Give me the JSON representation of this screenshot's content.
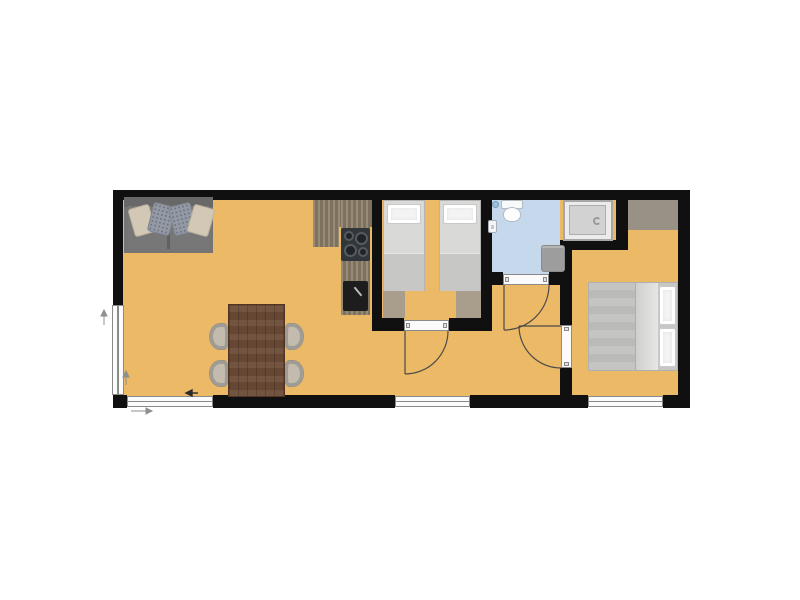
{
  "meta": {
    "kind": "apartment-floor-plan",
    "visible_text": "none",
    "background": "#ffffff"
  },
  "palette": {
    "wall": "#101010",
    "floor": "#ecb966",
    "bathroom-floor": "#c6d9ec",
    "window-fill": "#fbfbfb",
    "frame-line": "#8a8a8a",
    "counter-wood": "#8c7e68",
    "table-wood": "#6b4b36",
    "sofa-gray": "#757575",
    "chair-beige": "#c3bbad",
    "bed-mattress": "#d9d9d7",
    "bed-duvet": "#c7c7c5",
    "pillow-white": "#f4f4f4",
    "rug-tan": "#a89e8b",
    "wardrobe-tan": "#9a9186",
    "shower-gray": "#d2d2d2",
    "bath-mat-gray": "#9d9d9d",
    "stove-dark": "#31363a",
    "sink-dark": "#1d1d1d",
    "door-line": "#4a4a4a",
    "toilet-white": "#f7f9fa",
    "drain-blue": "#9dbdd8"
  },
  "rooms": [
    {
      "name": "living-room-kitchen",
      "floor": "#ecb966",
      "furniture": [
        "sofa-with-4-pillows",
        "dining-table",
        "chair x4",
        "kitchen-counter-L",
        "stove-4-burners",
        "kitchen-sink"
      ]
    },
    {
      "name": "twin-bedroom",
      "floor": "#ecb966",
      "furniture": [
        "single-bed x2",
        "foot-rug x2"
      ]
    },
    {
      "name": "bathroom",
      "floor": "#c6d9ec",
      "furniture": [
        "toilet",
        "wash-basin",
        "floor-drain",
        "shower-cabin",
        "bath-mat"
      ]
    },
    {
      "name": "double-bedroom",
      "floor": "#ecb966",
      "furniture": [
        "double-bed",
        "wardrobe-strip"
      ]
    },
    {
      "name": "hallway",
      "floor": "#ecb966",
      "furniture": []
    }
  ],
  "openings": {
    "doors": [
      "twin-bedroom-door",
      "bathroom-door",
      "double-bedroom-door"
    ],
    "windows": [
      "left-wall-window",
      "bottom-window-living",
      "bottom-window-hall",
      "bottom-window-bedroom"
    ]
  }
}
